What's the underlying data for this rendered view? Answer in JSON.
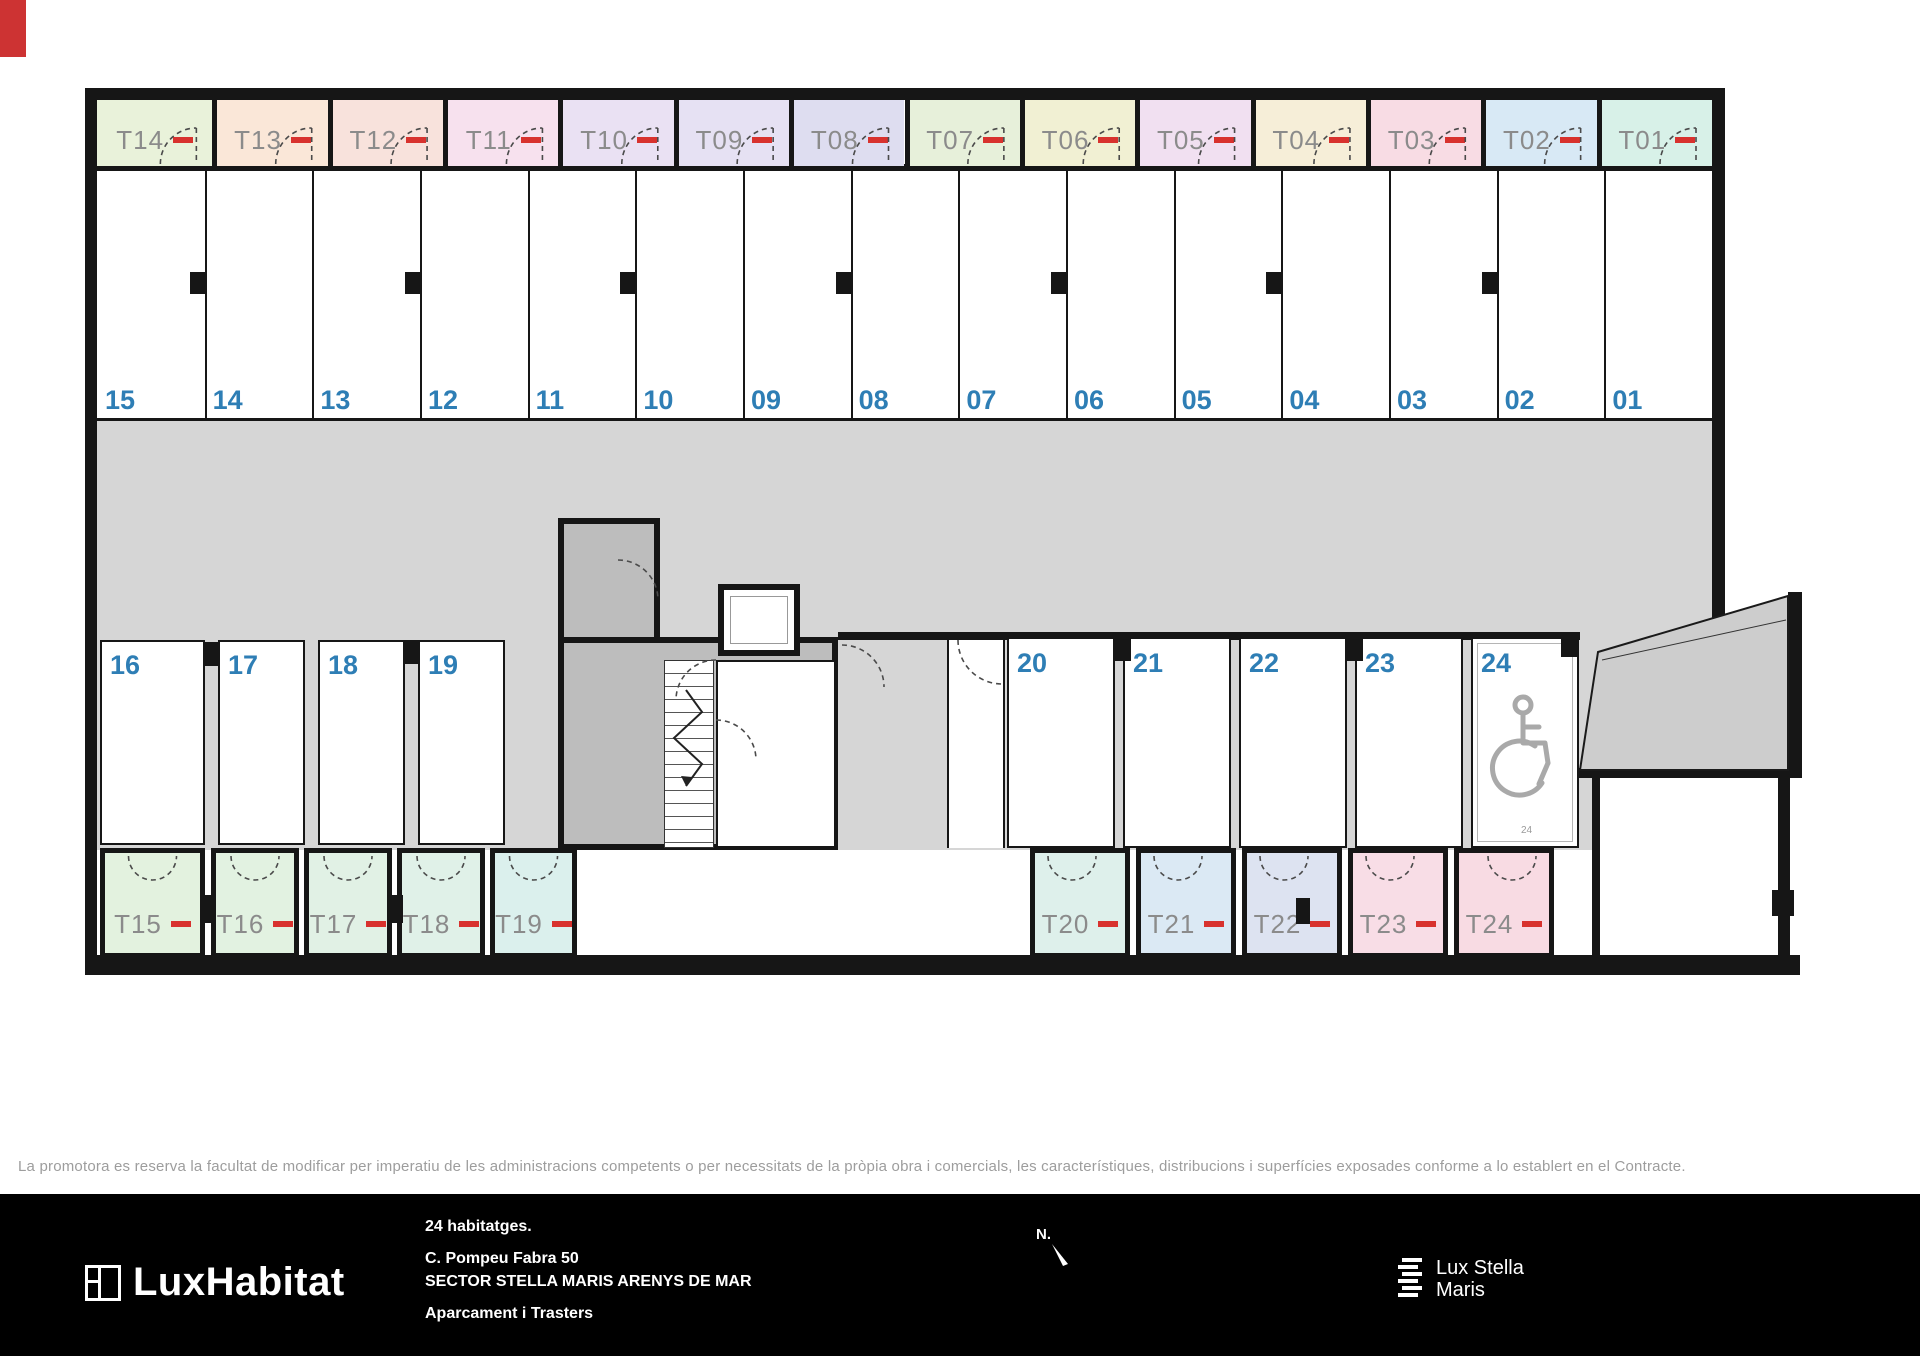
{
  "plan": {
    "colors": {
      "wall": "#161616",
      "lane": "#d6d6d6",
      "core": "#bdbdbd",
      "ramp": "#cdcdcd",
      "storage_label": "#8b8b8b",
      "parking_number": "#2e7eb5",
      "red_dash": "#d8322e"
    },
    "top_storage": [
      {
        "label": "T14",
        "color": "#e9f2da"
      },
      {
        "label": "T13",
        "color": "#fae7d8"
      },
      {
        "label": "T12",
        "color": "#f8e2dc"
      },
      {
        "label": "T11",
        "color": "#f7e1ee"
      },
      {
        "label": "T10",
        "color": "#eae1f3"
      },
      {
        "label": "T09",
        "color": "#e6e1f3"
      },
      {
        "label": "T08",
        "color": "#deddf0"
      },
      {
        "label": "T07",
        "color": "#e7f0da"
      },
      {
        "label": "T06",
        "color": "#f1f0d3"
      },
      {
        "label": "T05",
        "color": "#f1e0f1"
      },
      {
        "label": "T04",
        "color": "#f6eed8"
      },
      {
        "label": "T03",
        "color": "#f8dce4"
      },
      {
        "label": "T02",
        "color": "#d8e9f5"
      },
      {
        "label": "T01",
        "color": "#d8f1e8"
      }
    ],
    "top_parking": [
      "15",
      "14",
      "13",
      "12",
      "11",
      "10",
      "09",
      "08",
      "07",
      "06",
      "05",
      "04",
      "03",
      "02",
      "01"
    ],
    "left_parking": [
      "16",
      "17",
      "18",
      "19"
    ],
    "right_parking": [
      "20",
      "21",
      "22",
      "23",
      "24"
    ],
    "accessible_space_label": "24",
    "bottom_left_storage": [
      {
        "label": "T15",
        "color": "#e3f2df"
      },
      {
        "label": "T16",
        "color": "#e2f2e1"
      },
      {
        "label": "T17",
        "color": "#e1f1e5"
      },
      {
        "label": "T18",
        "color": "#e0f1e8"
      },
      {
        "label": "T19",
        "color": "#dbf0ed"
      }
    ],
    "bottom_right_storage": [
      {
        "label": "T20",
        "color": "#def0eb"
      },
      {
        "label": "T21",
        "color": "#dbe9f4"
      },
      {
        "label": "T22",
        "color": "#dde3f1"
      },
      {
        "label": "T23",
        "color": "#f8dde6"
      },
      {
        "label": "T24",
        "color": "#f8dbe3"
      }
    ]
  },
  "disclaimer": "La promotora es reserva la facultat de modificar per imperatiu de les administracions competents o per necessitats de la pròpia obra i comercials, les característiques, distribucions i superfícies exposades conforme a lo establert en el Contracte.",
  "footer": {
    "brand": "LuxHabitat",
    "units_line": "24 habitatges.",
    "address_line": "C. Pompeu Fabra 50",
    "sector_line": "SECTOR STELLA MARIS ARENYS DE MAR",
    "type_line": "Aparcament i Trasters",
    "north_label": "N.",
    "logo2_line1": "Lux Stella",
    "logo2_line2": "Maris"
  }
}
